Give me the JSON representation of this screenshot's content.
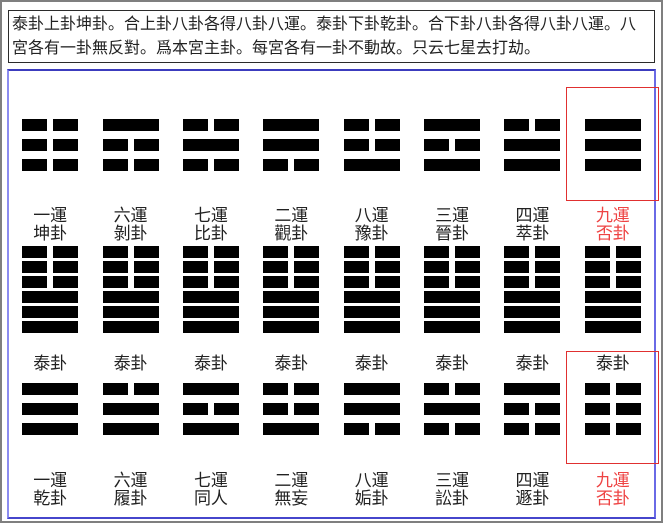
{
  "header": {
    "text": "泰卦上卦坤卦。合上卦八卦各得八卦八運。泰卦下卦乾卦。合下卦八卦各得八卦八運。八宮各有一卦無反對。爲本宮主卦。每宮各有一卦不動故。只云七星去打劫。"
  },
  "colors": {
    "page_border": "#7f7f7f",
    "header_border": "#2b2b2b",
    "panel_border_top": "#3c3cbe",
    "panel_border_right": "#6a6ae6",
    "panel_border_bottom": "#4646cc",
    "panel_border_left": "#8c8cf0",
    "highlight_red": "#e03030",
    "red_label": "#ee4444",
    "line_color": "#000000",
    "label_color": "#222222"
  },
  "legend": {
    "line_encoding": "1 = solid yang line, 0 = broken yin line, listed top to bottom as drawn"
  },
  "columns": [
    {
      "upper_trigram": {
        "name": "kun",
        "lines": [
          0,
          0,
          0
        ]
      },
      "upper_label": {
        "line1": "一運",
        "line2": "坤卦",
        "red": false
      },
      "hexagram": {
        "name": "tai",
        "lines": [
          0,
          0,
          0,
          1,
          1,
          1
        ]
      },
      "tai_label": "泰卦",
      "lower_trigram": {
        "name": "qian",
        "lines": [
          1,
          1,
          1
        ]
      },
      "lower_label": {
        "line1": "一運",
        "line2": "乾卦",
        "red": false
      },
      "highlight_upper": false,
      "highlight_lower": false
    },
    {
      "upper_trigram": {
        "name": "gen",
        "lines": [
          1,
          0,
          0
        ]
      },
      "upper_label": {
        "line1": "六運",
        "line2": "剝卦",
        "red": false
      },
      "hexagram": {
        "name": "tai",
        "lines": [
          0,
          0,
          0,
          1,
          1,
          1
        ]
      },
      "tai_label": "泰卦",
      "lower_trigram": {
        "name": "dui",
        "lines": [
          0,
          1,
          1
        ]
      },
      "lower_label": {
        "line1": "六運",
        "line2": "履卦",
        "red": false
      },
      "highlight_upper": false,
      "highlight_lower": false
    },
    {
      "upper_trigram": {
        "name": "kan",
        "lines": [
          0,
          1,
          0
        ]
      },
      "upper_label": {
        "line1": "七運",
        "line2": "比卦",
        "red": false
      },
      "hexagram": {
        "name": "tai",
        "lines": [
          0,
          0,
          0,
          1,
          1,
          1
        ]
      },
      "tai_label": "泰卦",
      "lower_trigram": {
        "name": "li",
        "lines": [
          1,
          0,
          1
        ]
      },
      "lower_label": {
        "line1": "七運",
        "line2": "同人",
        "red": false
      },
      "highlight_upper": false,
      "highlight_lower": false
    },
    {
      "upper_trigram": {
        "name": "xun",
        "lines": [
          1,
          1,
          0
        ]
      },
      "upper_label": {
        "line1": "二運",
        "line2": "觀卦",
        "red": false
      },
      "hexagram": {
        "name": "tai",
        "lines": [
          0,
          0,
          0,
          1,
          1,
          1
        ]
      },
      "tai_label": "泰卦",
      "lower_trigram": {
        "name": "zhen",
        "lines": [
          0,
          0,
          1
        ]
      },
      "lower_label": {
        "line1": "二運",
        "line2": "無妄",
        "red": false
      },
      "highlight_upper": false,
      "highlight_lower": false
    },
    {
      "upper_trigram": {
        "name": "zhen",
        "lines": [
          0,
          0,
          1
        ]
      },
      "upper_label": {
        "line1": "八運",
        "line2": "豫卦",
        "red": false
      },
      "hexagram": {
        "name": "tai",
        "lines": [
          0,
          0,
          0,
          1,
          1,
          1
        ]
      },
      "tai_label": "泰卦",
      "lower_trigram": {
        "name": "xun",
        "lines": [
          1,
          1,
          0
        ]
      },
      "lower_label": {
        "line1": "八運",
        "line2": "姤卦",
        "red": false
      },
      "highlight_upper": false,
      "highlight_lower": false
    },
    {
      "upper_trigram": {
        "name": "li",
        "lines": [
          1,
          0,
          1
        ]
      },
      "upper_label": {
        "line1": "三運",
        "line2": "晉卦",
        "red": false
      },
      "hexagram": {
        "name": "tai",
        "lines": [
          0,
          0,
          0,
          1,
          1,
          1
        ]
      },
      "tai_label": "泰卦",
      "lower_trigram": {
        "name": "kan",
        "lines": [
          0,
          1,
          0
        ]
      },
      "lower_label": {
        "line1": "三運",
        "line2": "訟卦",
        "red": false
      },
      "highlight_upper": false,
      "highlight_lower": false
    },
    {
      "upper_trigram": {
        "name": "dui",
        "lines": [
          0,
          1,
          1
        ]
      },
      "upper_label": {
        "line1": "四運",
        "line2": "萃卦",
        "red": false
      },
      "hexagram": {
        "name": "tai",
        "lines": [
          0,
          0,
          0,
          1,
          1,
          1
        ]
      },
      "tai_label": "泰卦",
      "lower_trigram": {
        "name": "gen",
        "lines": [
          1,
          0,
          0
        ]
      },
      "lower_label": {
        "line1": "四運",
        "line2": "遯卦",
        "red": false
      },
      "highlight_upper": false,
      "highlight_lower": false
    },
    {
      "upper_trigram": {
        "name": "qian",
        "lines": [
          1,
          1,
          1
        ]
      },
      "upper_label": {
        "line1": "九運",
        "line2": "否卦",
        "red": true
      },
      "hexagram": {
        "name": "tai",
        "lines": [
          0,
          0,
          0,
          1,
          1,
          1
        ]
      },
      "tai_label": "泰卦",
      "lower_trigram": {
        "name": "kun",
        "lines": [
          0,
          0,
          0
        ]
      },
      "lower_label": {
        "line1": "九運",
        "line2": "否卦",
        "red": true
      },
      "highlight_upper": true,
      "highlight_lower": true
    }
  ]
}
